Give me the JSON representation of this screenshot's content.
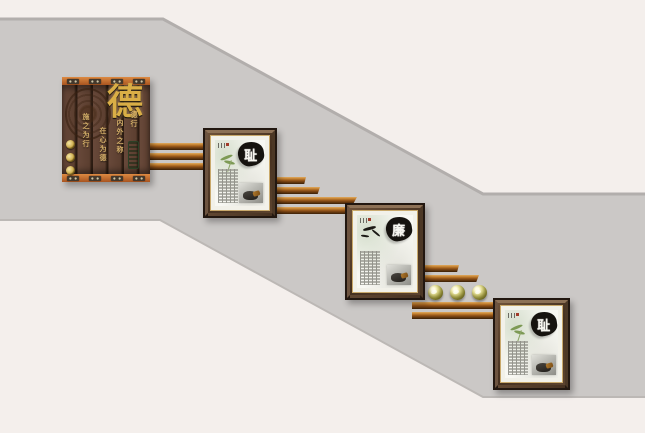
{
  "panel": {
    "main_char": "德",
    "columns": [
      "德行",
      "内外之称",
      "在心为德",
      "施之为行"
    ]
  },
  "frames": [
    {
      "char": "耻"
    },
    {
      "char": "廉"
    },
    {
      "char": "耻"
    }
  ],
  "colors": {
    "background_light": "#f4efec",
    "stair_band_gray": "#cbc8c6",
    "band_edge": "#b4b0ae",
    "slat_wood": "#b06820",
    "panel_trim_orange": "#c06a2c",
    "panel_plank_brown": "#5c3f30",
    "gold_text": "#d9ae46",
    "frame_bronze": "#4c3826",
    "sphere_gold": "#cfc878",
    "leaf_green": "#7d9a55",
    "ink_black": "#16130f",
    "jade_green": "#5c7a50"
  }
}
